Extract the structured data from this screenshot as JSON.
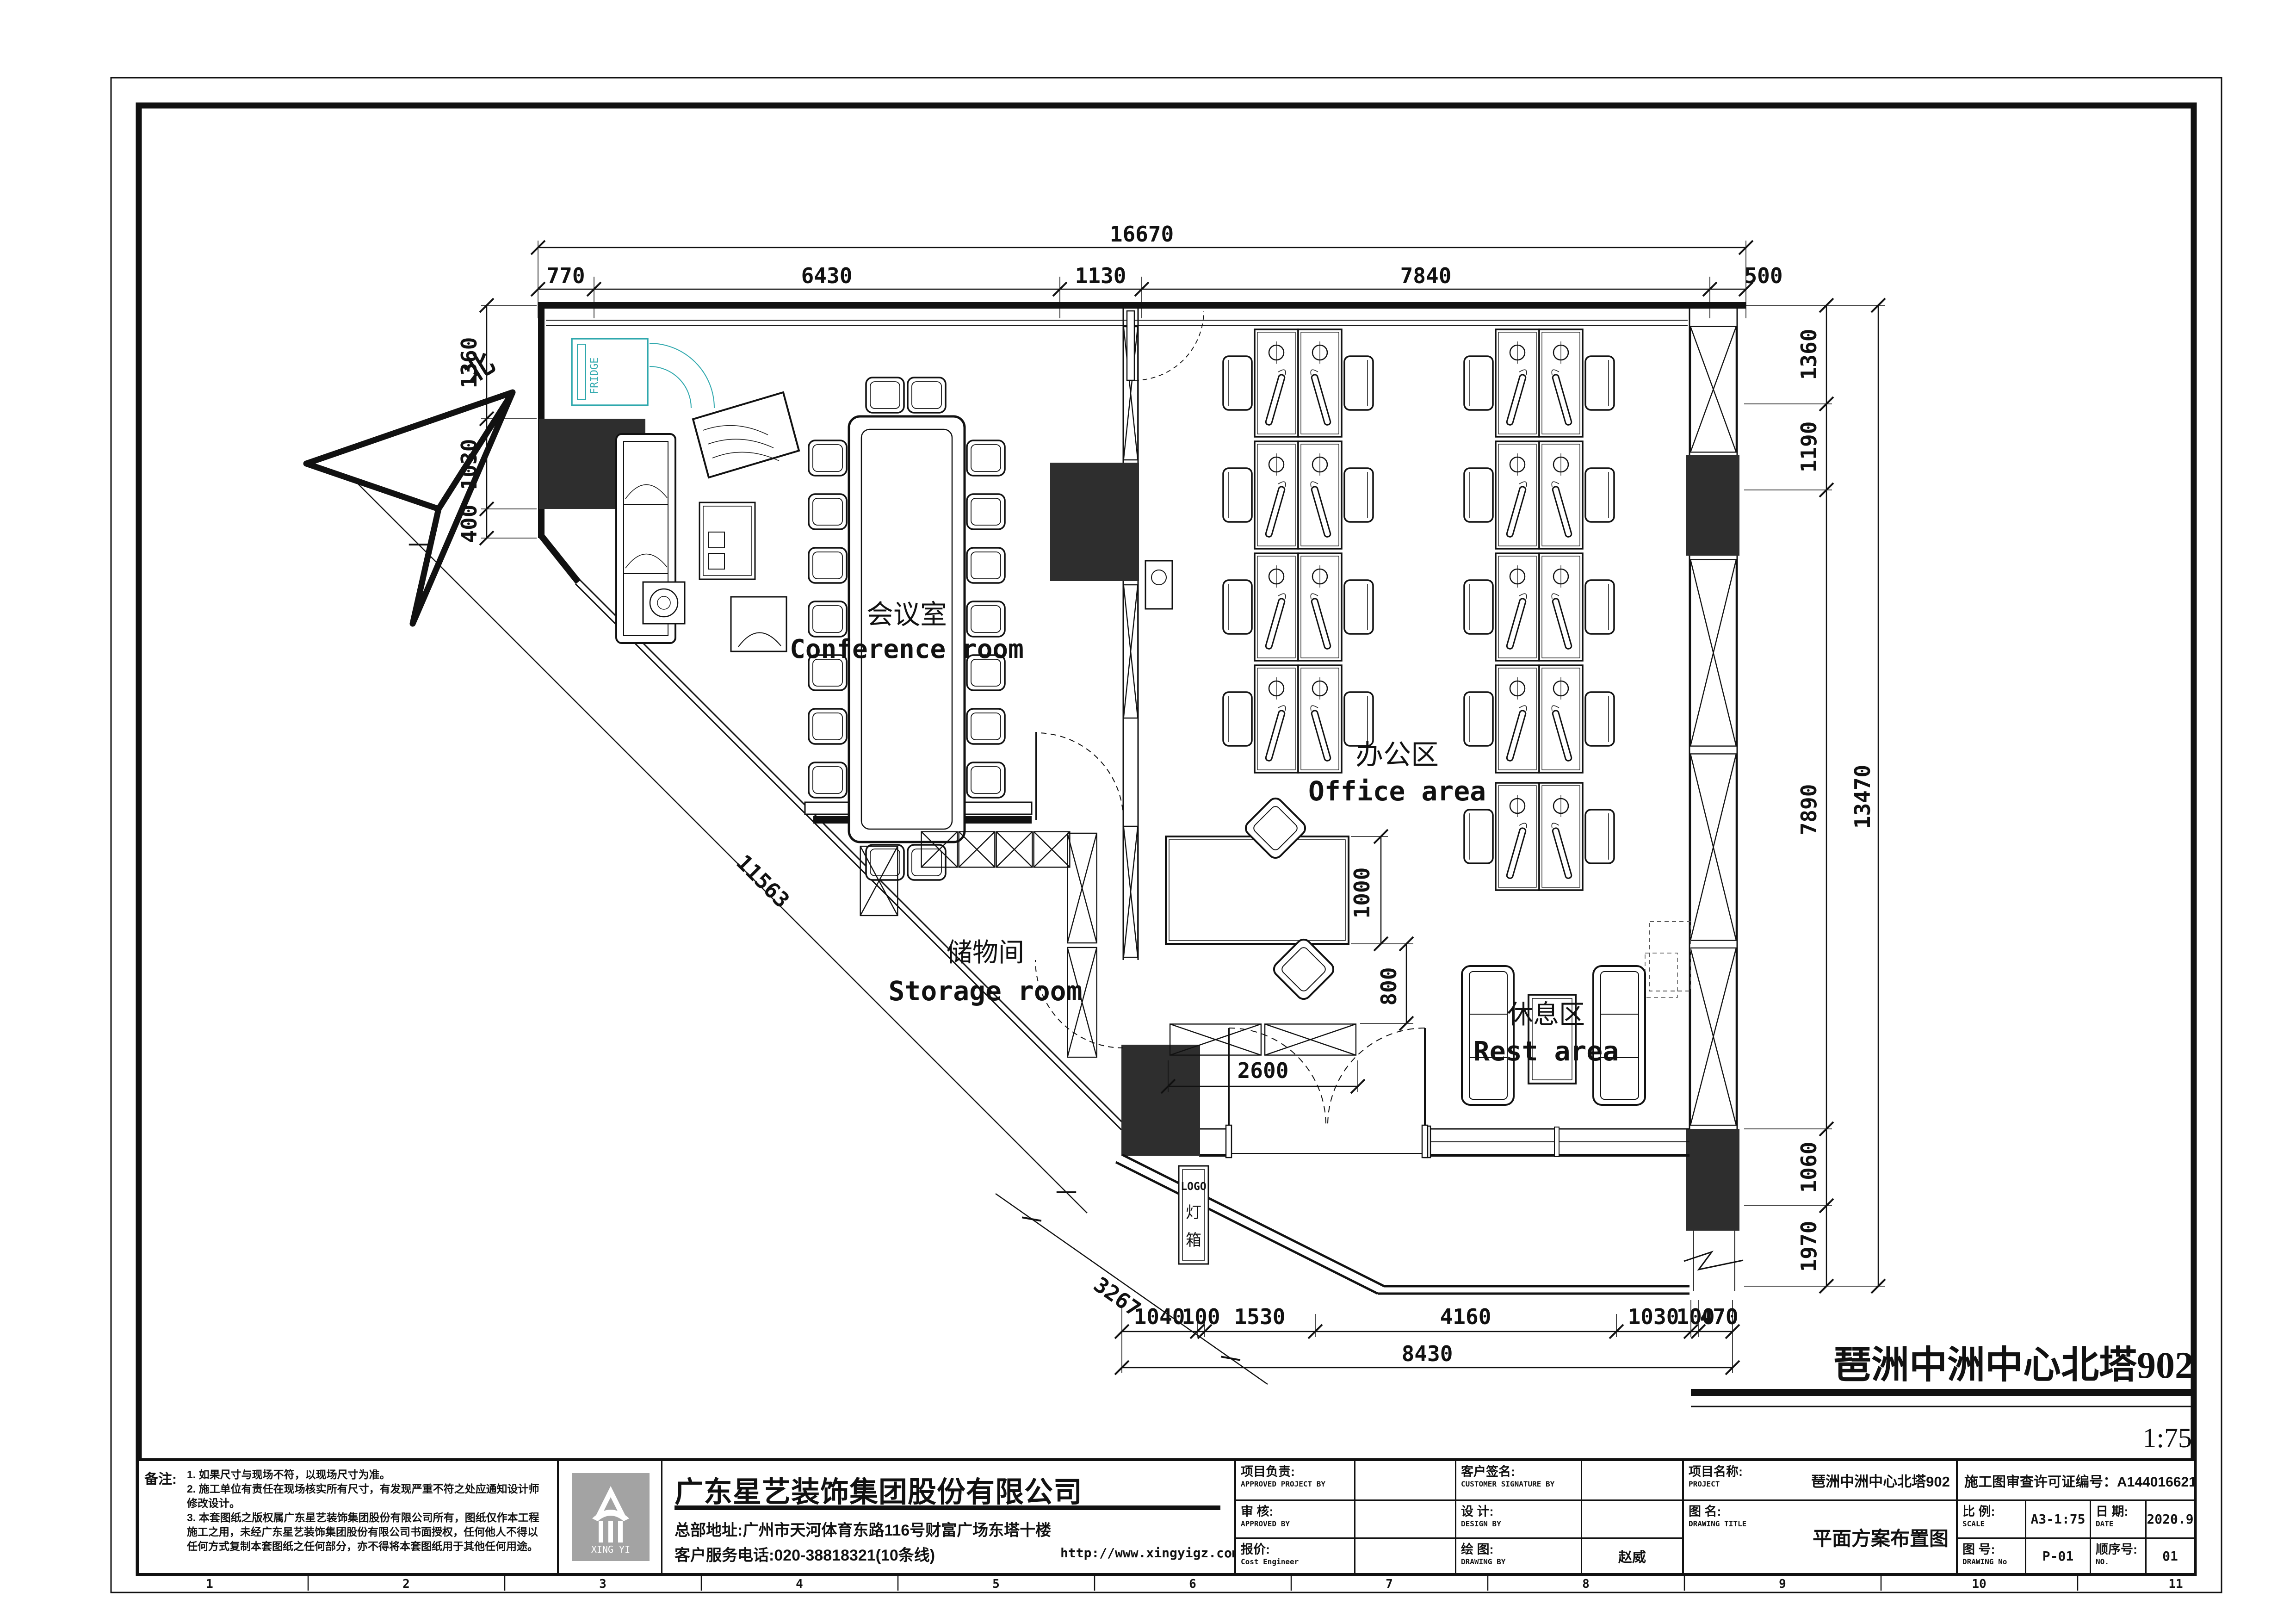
{
  "north_label": "北",
  "plan": {
    "rooms": {
      "conference_zh": "会议室",
      "conference_en": "Conference room",
      "office_zh": "办公区",
      "office_en": "Office area",
      "storage_zh": "储物间",
      "storage_en": "Storage room",
      "rest_zh": "休息区",
      "rest_en": "Rest area"
    },
    "fridge_label": "FRIDGE",
    "logo_box": {
      "line1": "LOGO",
      "line2": "灯",
      "line3": "箱"
    },
    "dims": {
      "top_total": "16670",
      "top": [
        "770",
        "6430",
        "1130",
        "7840",
        "500"
      ],
      "left": [
        "1360",
        "1030",
        "400"
      ],
      "right": [
        "1360",
        "1190",
        "7890",
        "1060",
        "1970"
      ],
      "right_total": "13470",
      "bottom": [
        "1040",
        "100",
        "1530",
        "4160",
        "1030",
        "100",
        "470"
      ],
      "bottom_total": "8430",
      "diag": "11563",
      "diag2": "3267",
      "rec": [
        "1000",
        "800",
        "2600"
      ]
    }
  },
  "drawing_title": {
    "text": "琶洲中洲中心北塔902",
    "scale": "1:75"
  },
  "ruler": [
    "1",
    "2",
    "3",
    "4",
    "5",
    "6",
    "7",
    "8",
    "9",
    "10",
    "11"
  ],
  "title_block": {
    "notes": {
      "label": "备注:",
      "lines": [
        "1. 如果尺寸与现场不符，以现场尺寸为准。",
        "2. 施工单位有责任在现场核实所有尺寸，有发现严重不符之处应通知设计师",
        "修改设计。",
        "3. 本套图纸之版权属广东星艺装饰集团股份有限公司所有，图纸仅作本工程",
        "施工之用，未经广东星艺装饰集团股份有限公司书面授权，任何他人不得以",
        "任何方式复制本套图纸之任何部分，亦不得将本套图纸用于其他任何用途。"
      ]
    },
    "company": {
      "name": "广东星艺装饰集团股份有限公司",
      "address": "总部地址:广州市天河体育东路116号财富广场东塔十楼",
      "phone": "客户服务电话:020-38818321(10条线)",
      "website": "http://www.xingyigz.com.cn",
      "logo_text": "XING YI"
    },
    "fields": {
      "approved_project": {
        "zh": "项目负责:",
        "en": "APPROVED PROJECT BY",
        "value": ""
      },
      "customer_sign": {
        "zh": "客户签名:",
        "en": "CUSTOMER SIGNATURE BY",
        "value": ""
      },
      "approved_by": {
        "zh": "审 核:",
        "en": "APPROVED BY",
        "value": ""
      },
      "design_by": {
        "zh": "设 计:",
        "en": "DESIGN BY",
        "value": ""
      },
      "cost": {
        "zh": "报价:",
        "en": "Cost Engineer",
        "value": ""
      },
      "drawing_by": {
        "zh": "绘 图:",
        "en": "DRAWING BY",
        "value": "赵威"
      }
    },
    "project": {
      "zh": "项目名称:",
      "en": "PROJECT",
      "value": "琶洲中洲中心北塔902"
    },
    "drawing": {
      "zh": "图 名:",
      "en": "DRAWING TITLE",
      "value": "平面方案布置图"
    },
    "permit": {
      "label": "施工图审查许可证编号：",
      "value": "A144016621(甲级)"
    },
    "scale": {
      "zh": "比 例:",
      "en": "SCALE",
      "value": "A3-1:75"
    },
    "date": {
      "zh": "日 期:",
      "en": "DATE",
      "value": "2020.9"
    },
    "drawing_no": {
      "zh": "图 号:",
      "en": "DRAWING No",
      "value": "P-01"
    },
    "seq_no": {
      "zh": "顺序号:",
      "en": "NO.",
      "value": "01"
    }
  }
}
